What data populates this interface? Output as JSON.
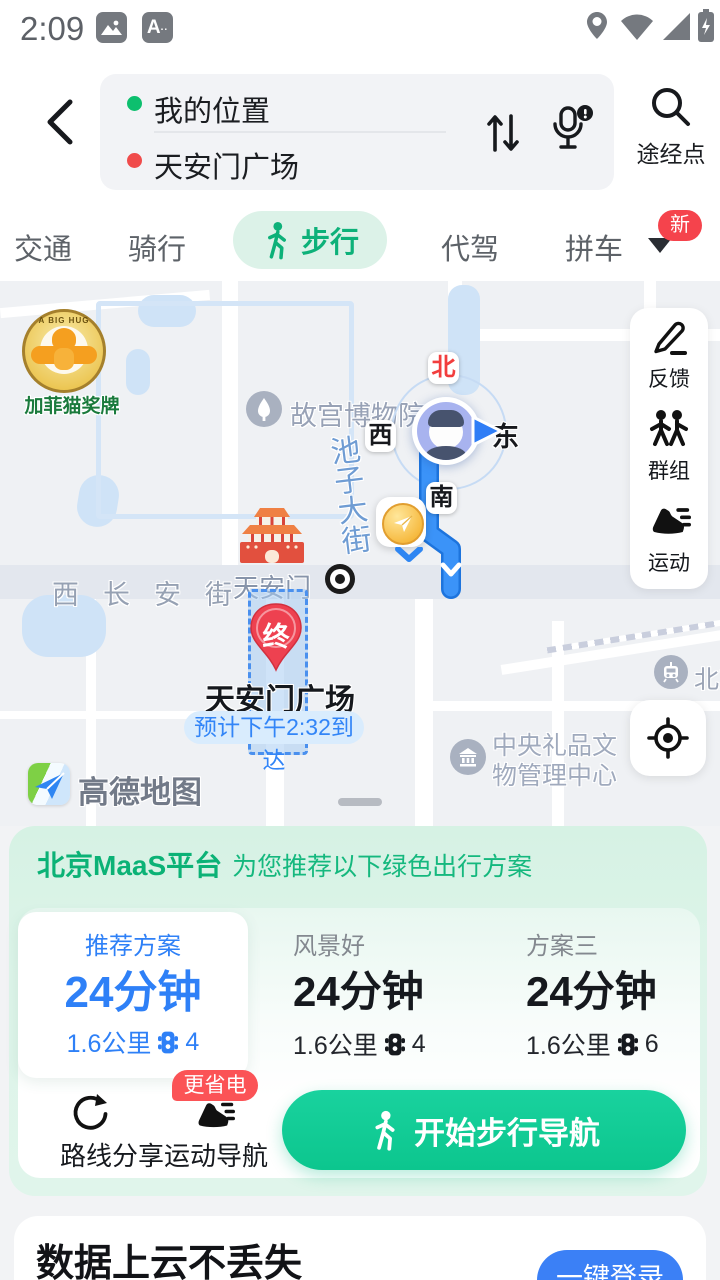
{
  "status_bar": {
    "time": "2:09"
  },
  "header": {
    "origin": "我的位置",
    "destination": "天安门广场",
    "waypoint_label": "途经点"
  },
  "tabs": {
    "items": [
      "交通",
      "骑行",
      "步行",
      "代驾",
      "拼车"
    ],
    "active": "步行",
    "new_badge": "新"
  },
  "map": {
    "ad": {
      "badge_text": "A BIG HUG",
      "label": "加菲猫奖牌"
    },
    "poi_palace": "故宫博物院",
    "compass": {
      "north": "北",
      "west": "西",
      "east": "东",
      "south": "南"
    },
    "street_vertical": "池子大街",
    "street_changan": "西长安街",
    "poi_tiananmen": "天安门",
    "destination_pin": "终",
    "destination_label": "天安门广场",
    "eta": "预计下午2:32到达",
    "poi_gift_line1": "中央礼品文",
    "poi_gift_line2": "物管理中心",
    "poi_station": "北京",
    "logo": "高德地图",
    "tools": [
      {
        "label": "反馈"
      },
      {
        "label": "群组"
      },
      {
        "label": "运动"
      }
    ]
  },
  "sheet": {
    "maas_title": "北京MaaS平台",
    "maas_subtitle": "为您推荐以下绿色出行方案",
    "options": [
      {
        "label": "推荐方案",
        "duration": "24分钟",
        "distance": "1.6公里",
        "lights": "4"
      },
      {
        "label": "风景好",
        "duration": "24分钟",
        "distance": "1.6公里",
        "lights": "4"
      },
      {
        "label": "方案三",
        "duration": "24分钟",
        "distance": "1.6公里",
        "lights": "6"
      }
    ],
    "share_label": "路线分享",
    "sport_nav_label": "运动导航",
    "sport_nav_badge": "更省电",
    "start_button": "开始步行导航"
  },
  "login": {
    "title": "数据上云不丢失",
    "button": "一键登录"
  },
  "colors": {
    "accent_green": "#0db179",
    "accent_blue": "#2e80f7",
    "badge_red": "#f5434c",
    "route_blue": "#2e8bf4",
    "pin_red": "#ee4150"
  }
}
